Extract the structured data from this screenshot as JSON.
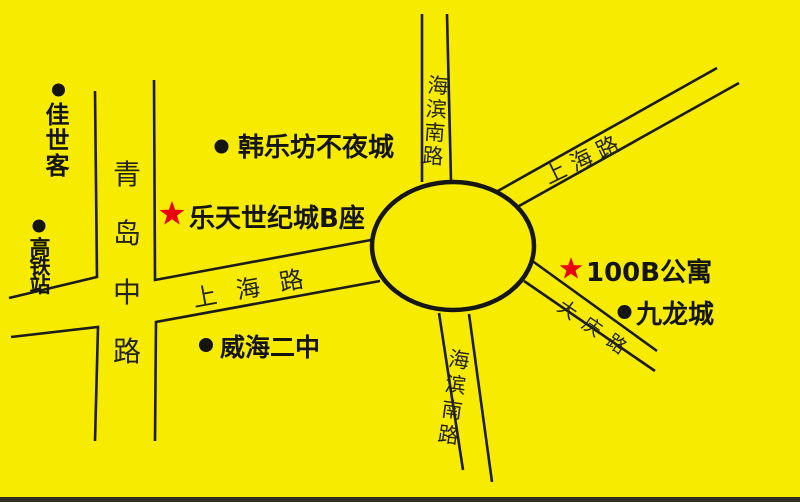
{
  "colors": {
    "background": "#F7EB00",
    "ink": "#1C1C18",
    "star": "#E8000F",
    "bottom_edge": "#2E2E24"
  },
  "roads": {
    "qingdao_middle": "青岛中路",
    "shanghai_west": "上海路",
    "shanghai_northeast": "上海路",
    "haibin_south_north_segment": "海滨南路",
    "haibin_south_south_segment": "海滨南路",
    "daqing": "大庆路"
  },
  "places": {
    "jiashike": "佳世客",
    "gaotiezhan": "高铁站",
    "hanlefang": "韩乐坊不夜城",
    "letian_b": "乐天世纪城B座",
    "weihai_no2": "威海二中",
    "apartment_100b": "100B公寓",
    "jiulongcheng": "九龙城"
  },
  "markers": {
    "dot": "bullet-dot",
    "star": "red-star"
  }
}
